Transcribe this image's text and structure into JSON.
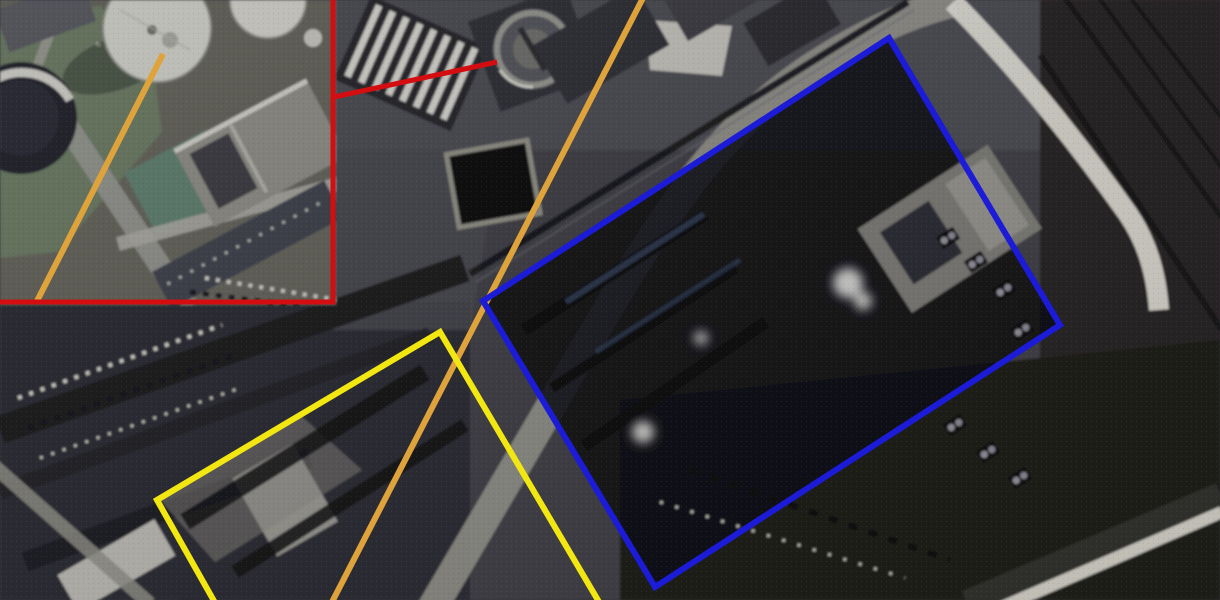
{
  "meta": {
    "type": "annotated-satellite-image",
    "width": 1220,
    "height": 600
  },
  "palette": {
    "annotation_red": "#d40d10",
    "annotation_orange": "#dfa33c",
    "annotation_yellow": "#f3e712",
    "annotation_blue": "#1b1bd8",
    "ground_dark": "#2a2a2f",
    "ground_mid": "#44454c",
    "concrete_light": "#8d8c84",
    "road_white": "#d7d5cb",
    "field_green": "#66755f"
  },
  "annotations": {
    "inset_box": {
      "label": "red-inset-box",
      "color": "#d40d10",
      "stroke_width": 5,
      "points": "-8,-8 333,-8 333,302 -8,302"
    },
    "inset_leader_line": {
      "label": "red-leader-line",
      "color": "#d40d10",
      "stroke_width": 5,
      "x1": 334,
      "y1": 97,
      "x2": 497,
      "y2": 62
    },
    "inset_orange_line": {
      "label": "orange-line-inset",
      "color": "#dfa33c",
      "stroke_width": 6,
      "x1": 163,
      "y1": 54,
      "x2": 37,
      "y2": 301
    },
    "main_orange_line": {
      "label": "orange-line-main",
      "color": "#dfa33c",
      "stroke_width": 6,
      "x1": 644,
      "y1": -4,
      "x2": 331,
      "y2": 604
    },
    "yellow_area": {
      "label": "yellow-highlight-area",
      "color": "#f3e712",
      "stroke_width": 6,
      "points": "157,500 440,332 612,624 227,624"
    },
    "blue_area": {
      "label": "blue-highlight-area",
      "color": "#1b1bd8",
      "stroke_width": 6,
      "points": "483,301 889,38 1060,325 655,587"
    }
  },
  "scene": {
    "description": "satellite view of an industrial plant with zoom inset and highlighted areas",
    "inset_landmarks": [
      "storage-tank-large",
      "storage-tank-dark",
      "storage-tank-partial",
      "warehouse-buildings",
      "green-field"
    ],
    "main_landmarks": [
      "circular-tank",
      "pipe-rack",
      "settling-basin",
      "diagonal-main-road",
      "white-perimeter-road",
      "railway-sidings",
      "power-plant-block",
      "steam-plumes",
      "coal-yard-rows",
      "cooling-units",
      "bottom-right-road"
    ]
  }
}
